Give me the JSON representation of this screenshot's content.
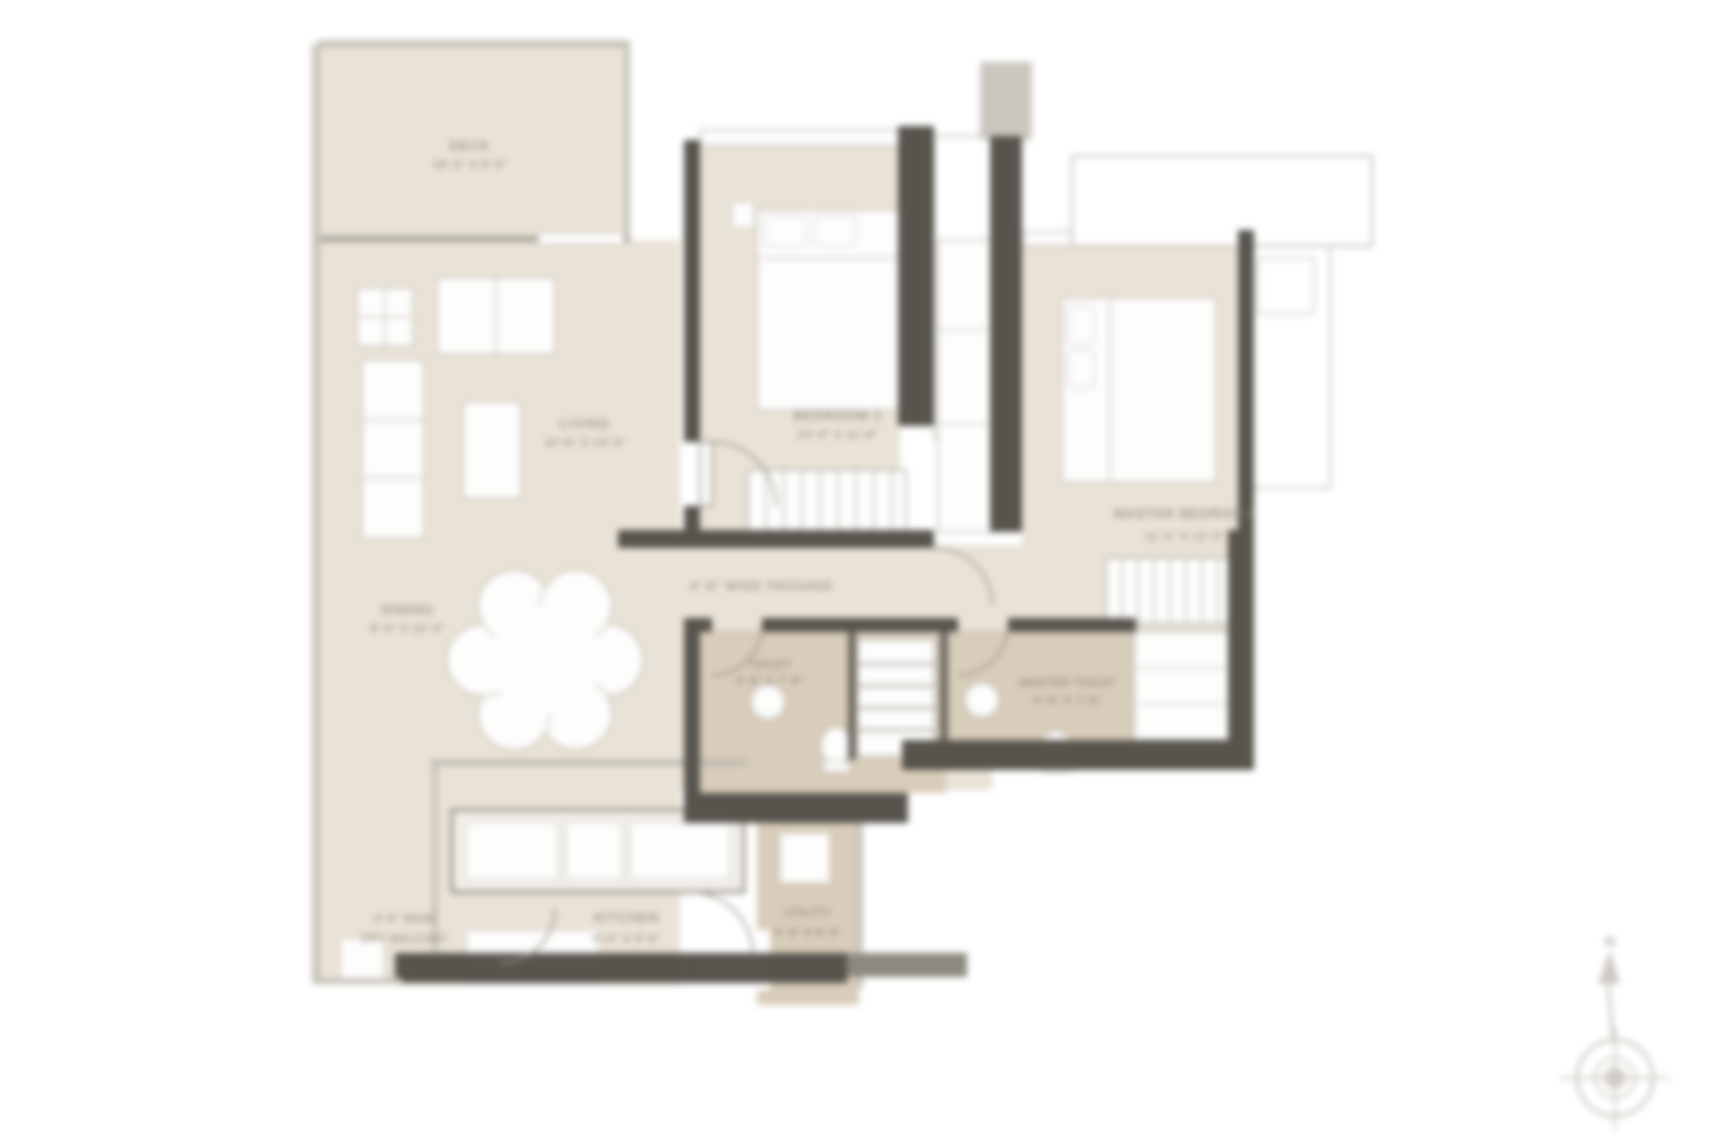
{
  "document": {
    "type": "Residential Apartment Floor Plan"
  },
  "colors": {
    "background": "#ffffff",
    "floor": "#e9e2d6",
    "floor_dark": "#d8ccba",
    "wall_dark": "#57544d",
    "wall_light": "#c7c3bb",
    "fixture": "#fdfdfc",
    "label_text": "#7b7466"
  },
  "rooms": {
    "deck": {
      "label": "DECK",
      "dims": "18'-0\" X 6'-6\""
    },
    "living": {
      "label": "LIVING",
      "dims": "10'-6\" X 13'-0\""
    },
    "dining": {
      "label": "DINING",
      "dims": "8'-0\" X 10'-0\""
    },
    "bedroom2": {
      "label": "BEDROOM 2",
      "dims": "10'-0\" X 11'-6\""
    },
    "master_bedroom": {
      "label": "MASTER BEDROOM",
      "dims": "11'-0\" X 12'-0\""
    },
    "toilet": {
      "label": "TOILET",
      "dims": "4'-6\" X 7'-6\""
    },
    "master_toilet": {
      "label": "MASTER TOILET",
      "dims": "5'-0\" X 7'-6\""
    },
    "kitchen": {
      "label": "KITCHEN",
      "dims": "8'-0\" X 9'-6\""
    },
    "dry_balcony": {
      "label": "3'-6\" WIDE",
      "dims": "DRY BALCONY"
    },
    "utility": {
      "label": "UTILITY",
      "dims": "3'-3\" X 6'-0\""
    }
  },
  "passage": {
    "label": "4'-6\" WIDE PASSAGE"
  },
  "compass": {
    "north_label": "N"
  }
}
